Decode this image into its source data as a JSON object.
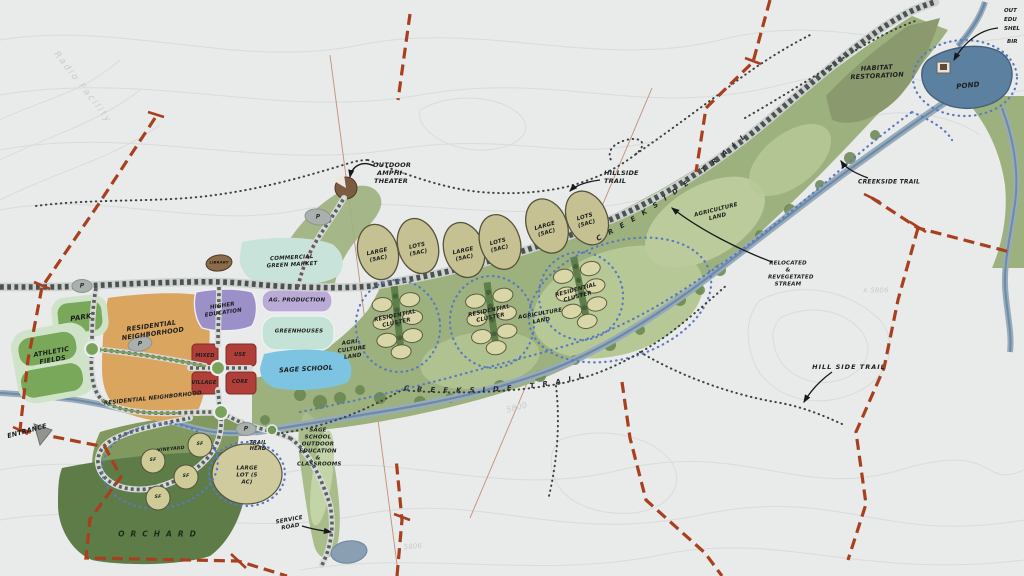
{
  "map_title": "Master plan sketch",
  "colors": {
    "paper": "#e9eaea",
    "contour": "#d8dcdb",
    "boundary_red": "#a8401f",
    "road_dark": "#4b5250",
    "road_casing": "#cdd2d0",
    "corridor_green": "#9db17e",
    "ag_green": "#b7c897",
    "tree_green": "#69854f",
    "habitat_olive": "#8a9a6e",
    "orchard_green": "#5e7c48",
    "vineyard_green": "#81995e",
    "pond_blue": "#5c80a0",
    "stream_blue": "#6d8aa6",
    "stream_band": "#98abbb",
    "trail_dot_black": "#3c4240",
    "trail_dot_blue": "#5b79c0",
    "lot_tan": "#c5c192",
    "cluster_tan": "#d9d6a8",
    "residential_orange": "#d9a55f",
    "park_green": "#79a85a",
    "mint_border": "#cfe3c8",
    "higher_ed_purple": "#9c90c9",
    "ag_production_lavender": "#b9abd6",
    "greenhouse_mint": "#c4e2d6",
    "school_blue": "#7cc4e2",
    "mixed_use_red": "#b03f3a",
    "parking_gray": "#aab0ac",
    "amphitheater_brown": "#7b5c41"
  },
  "labels": {
    "entrance": "ENTRANCE",
    "park": "PARK",
    "parking": "P",
    "athletic_fields": "ATHLETIC FIELDS",
    "residential_neighborhood": "RESIDENTIAL NEIGHBORHOOD",
    "higher_education": "HIGHER EDUCATION",
    "mixed": "MIXED",
    "use": "USE",
    "village": "VILLAGE",
    "core": "CORE",
    "ag_production": "AG. PRODUCTION",
    "greenhouses": "GREENHOUSES",
    "commercial_green_market": "COMMERCIAL GREEN MARKET",
    "library": "LIBRARY",
    "outdoor_amphitheater": "OUTDOOR AMPHI-THEATER",
    "sage_school": "SAGE SCHOOL",
    "agri_culture_land": "AGRI-CULTURE LAND",
    "large_5ac": "LARGE (5AC)",
    "lots_5ac": "LOTS (5AC)",
    "residential_cluster": "RESIDENTIAL CLUSTER",
    "agriculture_land": "AGRICULTURE LAND",
    "hillside_trail": "HILLSIDE TRAIL",
    "hill_side_trail": "HILL SIDE TRAIL",
    "creekside_trail": "CREEKSIDE TRAIL",
    "habitat_restoration": "HABITAT RESTORATION",
    "pond": "POND",
    "relocated_stream": "RELOCATED & REVEGETATED STREAM",
    "orchard": "ORCHARD",
    "vineyard": "VINEYARD",
    "sf_lot": "SF",
    "large_lot_5ac": "LARGE LOT (5 AC)",
    "trail_head": "TRAIL HEAD",
    "sage_school_outdoor": "SAGE SCHOOL OUTDOOR EDUCATION & CLASSROOMS",
    "service_road": "SERVICE ROAD",
    "edge_cut_1": "OUT",
    "edge_cut_2": "EDU",
    "edge_cut_3": "SHEL",
    "edge_cut_4": "BIR",
    "radio_facility": "Radio Facility",
    "elev_5800": "5800",
    "elev_x5806": "x 5806",
    "elev_5806": "5806"
  }
}
